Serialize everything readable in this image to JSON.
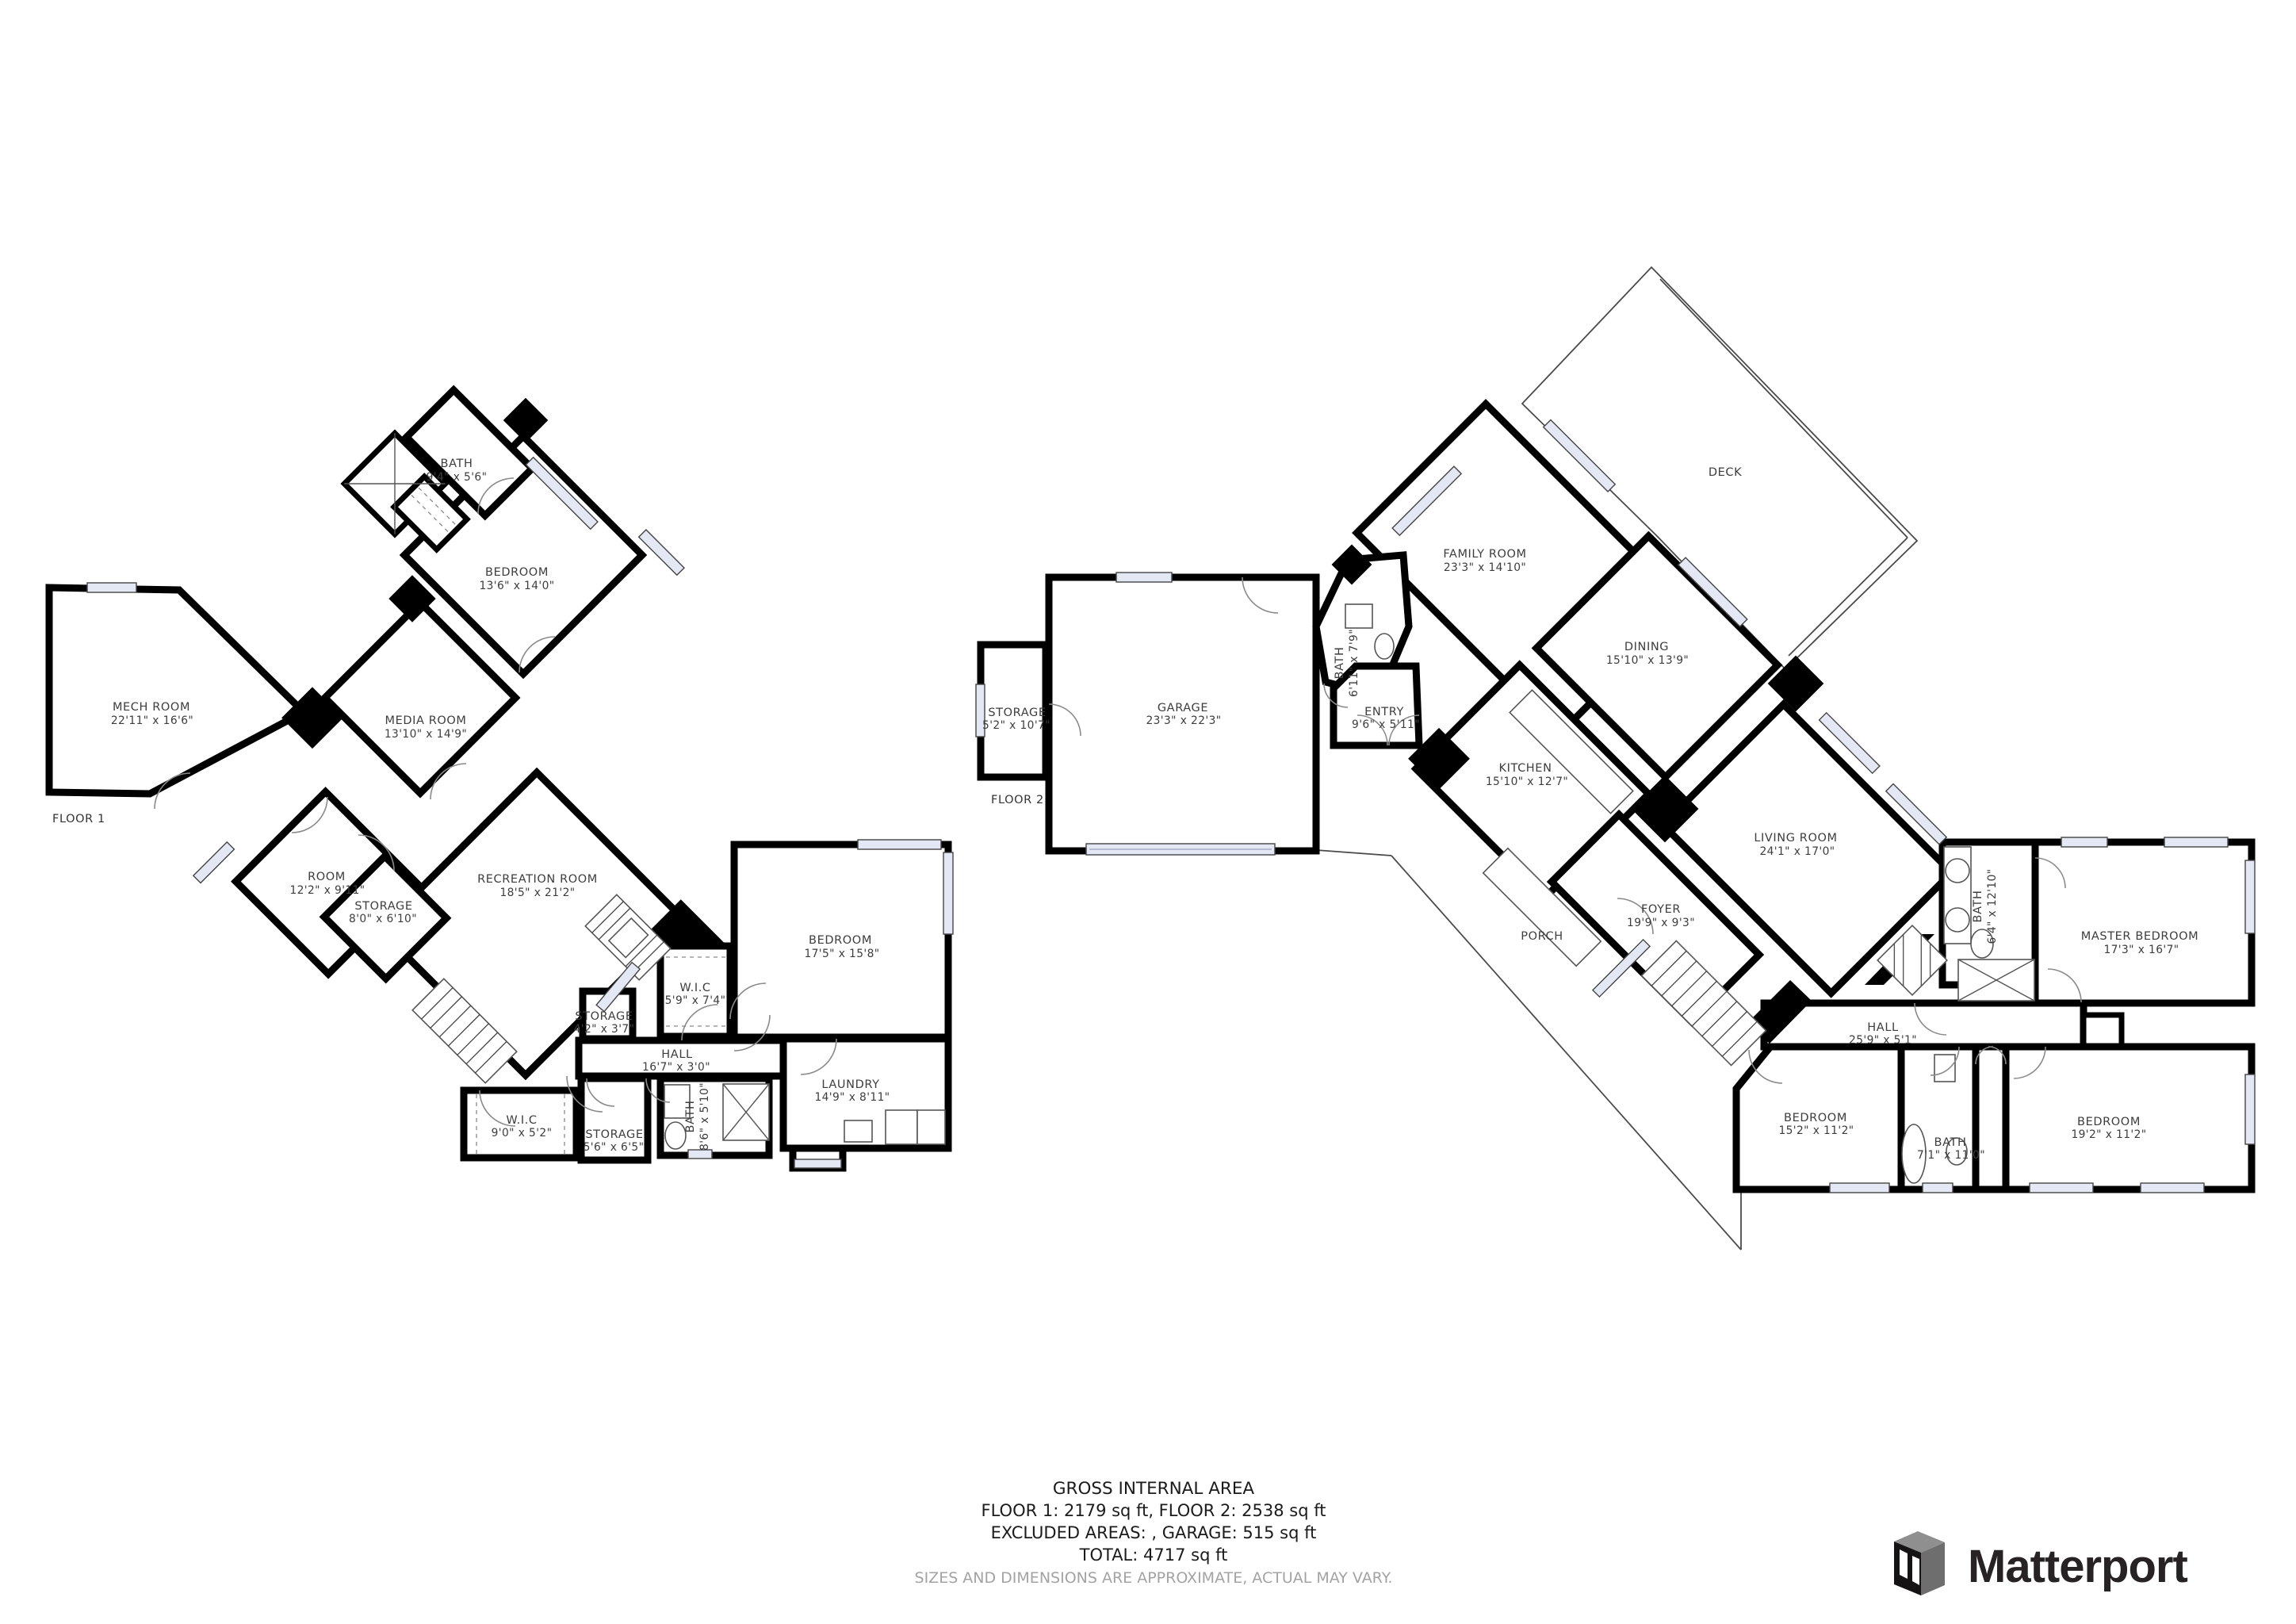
{
  "floor1": {
    "label": "FLOOR 1",
    "rooms": [
      {
        "name": "BATH",
        "dims": "9'4\" x 5'6\""
      },
      {
        "name": "BEDROOM",
        "dims": "13'6\" x 14'0\""
      },
      {
        "name": "MECH ROOM",
        "dims": "22'11\" x 16'6\""
      },
      {
        "name": "MEDIA ROOM",
        "dims": "13'10\" x 14'9\""
      },
      {
        "name": "ROOM",
        "dims": "12'2\" x 9'11\""
      },
      {
        "name": "STORAGE",
        "dims": "8'0\" x 6'10\""
      },
      {
        "name": "RECREATION ROOM",
        "dims": "18'5\" x 21'2\""
      },
      {
        "name": "BEDROOM",
        "dims": "17'5\" x 15'8\""
      },
      {
        "name": "W.I.C",
        "dims": "5'9\" x 7'4\""
      },
      {
        "name": "STORAGE",
        "dims": "4'2\" x 3'7\""
      },
      {
        "name": "HALL",
        "dims": "16'7\" x 3'0\""
      },
      {
        "name": "LAUNDRY",
        "dims": "14'9\" x 8'11\""
      },
      {
        "name": "W.I.C",
        "dims": "9'0\" x 5'2\""
      },
      {
        "name": "STORAGE",
        "dims": "5'6\" x 6'5\""
      },
      {
        "name": "BATH",
        "dims": "8'6\" x 5'10\""
      }
    ]
  },
  "floor2": {
    "label": "FLOOR 2",
    "rooms": [
      {
        "name": "DECK",
        "dims": ""
      },
      {
        "name": "FAMILY ROOM",
        "dims": "23'3\" x 14'10\""
      },
      {
        "name": "DINING",
        "dims": "15'10\" x 13'9\""
      },
      {
        "name": "STORAGE",
        "dims": "5'2\" x 10'7\""
      },
      {
        "name": "GARAGE",
        "dims": "23'3\" x 22'3\""
      },
      {
        "name": "BATH",
        "dims": "6'11\" x 7'9\""
      },
      {
        "name": "ENTRY",
        "dims": "9'6\" x 5'11\""
      },
      {
        "name": "KITCHEN",
        "dims": "15'10\" x 12'7\""
      },
      {
        "name": "LIVING ROOM",
        "dims": "24'1\" x 17'0\""
      },
      {
        "name": "FOYER",
        "dims": "19'9\" x 9'3\""
      },
      {
        "name": "PORCH",
        "dims": ""
      },
      {
        "name": "HALL",
        "dims": "25'9\" x 5'1\""
      },
      {
        "name": "BATH",
        "dims": "6'4\" x 12'10\""
      },
      {
        "name": "MASTER BEDROOM",
        "dims": "17'3\" x 16'7\""
      },
      {
        "name": "BEDROOM",
        "dims": "15'2\" x 11'2\""
      },
      {
        "name": "BATH",
        "dims": "7'1\" x 11'0\""
      },
      {
        "name": "BEDROOM",
        "dims": "19'2\" x 11'2\""
      }
    ]
  },
  "summary": {
    "title": "GROSS INTERNAL AREA",
    "line1": "FLOOR 1: 2179 sq ft, FLOOR 2: 2538 sq ft",
    "line2": "EXCLUDED AREAS: , GARAGE: 515 sq ft",
    "line3": "TOTAL: 4717 sq ft",
    "disclaimer": "SIZES AND DIMENSIONS ARE APPROXIMATE, ACTUAL MAY VARY."
  },
  "branding": {
    "logo_text": "Matterport"
  }
}
